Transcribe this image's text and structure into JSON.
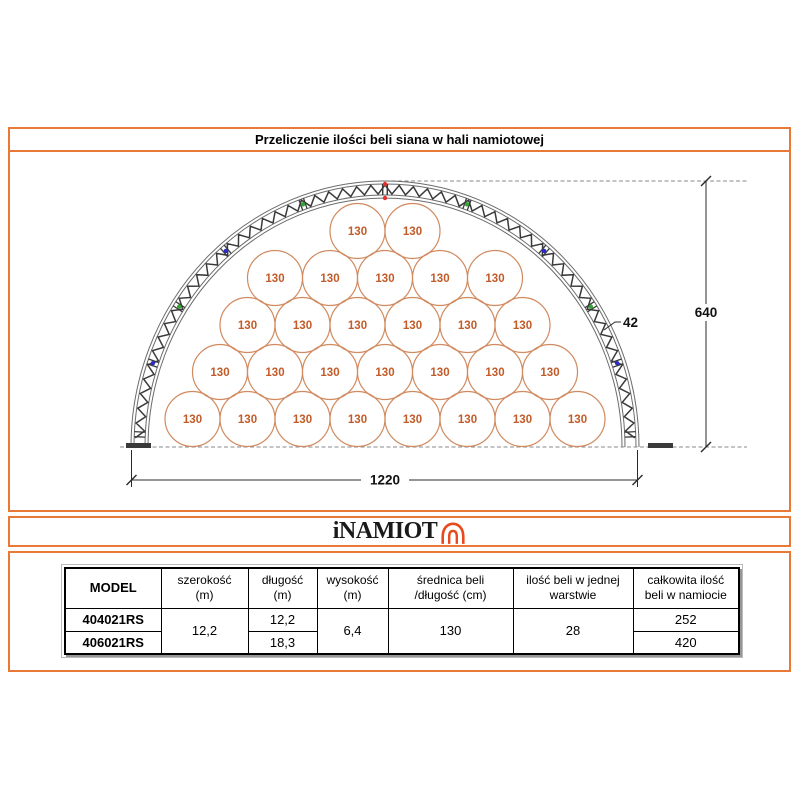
{
  "title": "Przeliczenie ilości beli siana w hali namiotowej",
  "logo": {
    "text": "iNAMIOT",
    "icon": "tent-icon"
  },
  "colors": {
    "frame": "#E87937",
    "bale_stroke": "#D18A5F",
    "bale_text": "#C25B28",
    "truss": "#3a3a3a",
    "chord": "#6b6b6b",
    "dim": "#2b2b2b",
    "ground": "#8a8a8a",
    "logo_icon": "#E84A1E",
    "dot_red": "#E53030",
    "dot_green": "#33A532",
    "dot_blue": "#2B2BC8"
  },
  "diagram": {
    "bale_label": "130",
    "bale_rows": [
      2,
      5,
      6,
      7,
      8
    ],
    "bales_total": 28,
    "height_label": "640",
    "width_label": "1220",
    "truss_depth_label": "42"
  },
  "table": {
    "headers": [
      {
        "line1": "MODEL",
        "line2": ""
      },
      {
        "line1": "szerokość",
        "line2": "(m)"
      },
      {
        "line1": "długość",
        "line2": "(m)"
      },
      {
        "line1": "wysokość",
        "line2": "(m)"
      },
      {
        "line1": "średnica beli",
        "line2": "/długość (cm)"
      },
      {
        "line1": "ilość beli w jednej",
        "line2": "warstwie"
      },
      {
        "line1": "całkowita ilość",
        "line2": "beli w namiocie"
      }
    ],
    "rows": [
      {
        "model": "404021RS",
        "szerokosc": "12,2",
        "dlugosc": "12,2",
        "wysokosc": "6,4",
        "srednica": "130",
        "ilosc": "28",
        "calkowita": "252"
      },
      {
        "model": "406021RS",
        "dlugosc": "18,3",
        "calkowita": "420"
      }
    ]
  }
}
